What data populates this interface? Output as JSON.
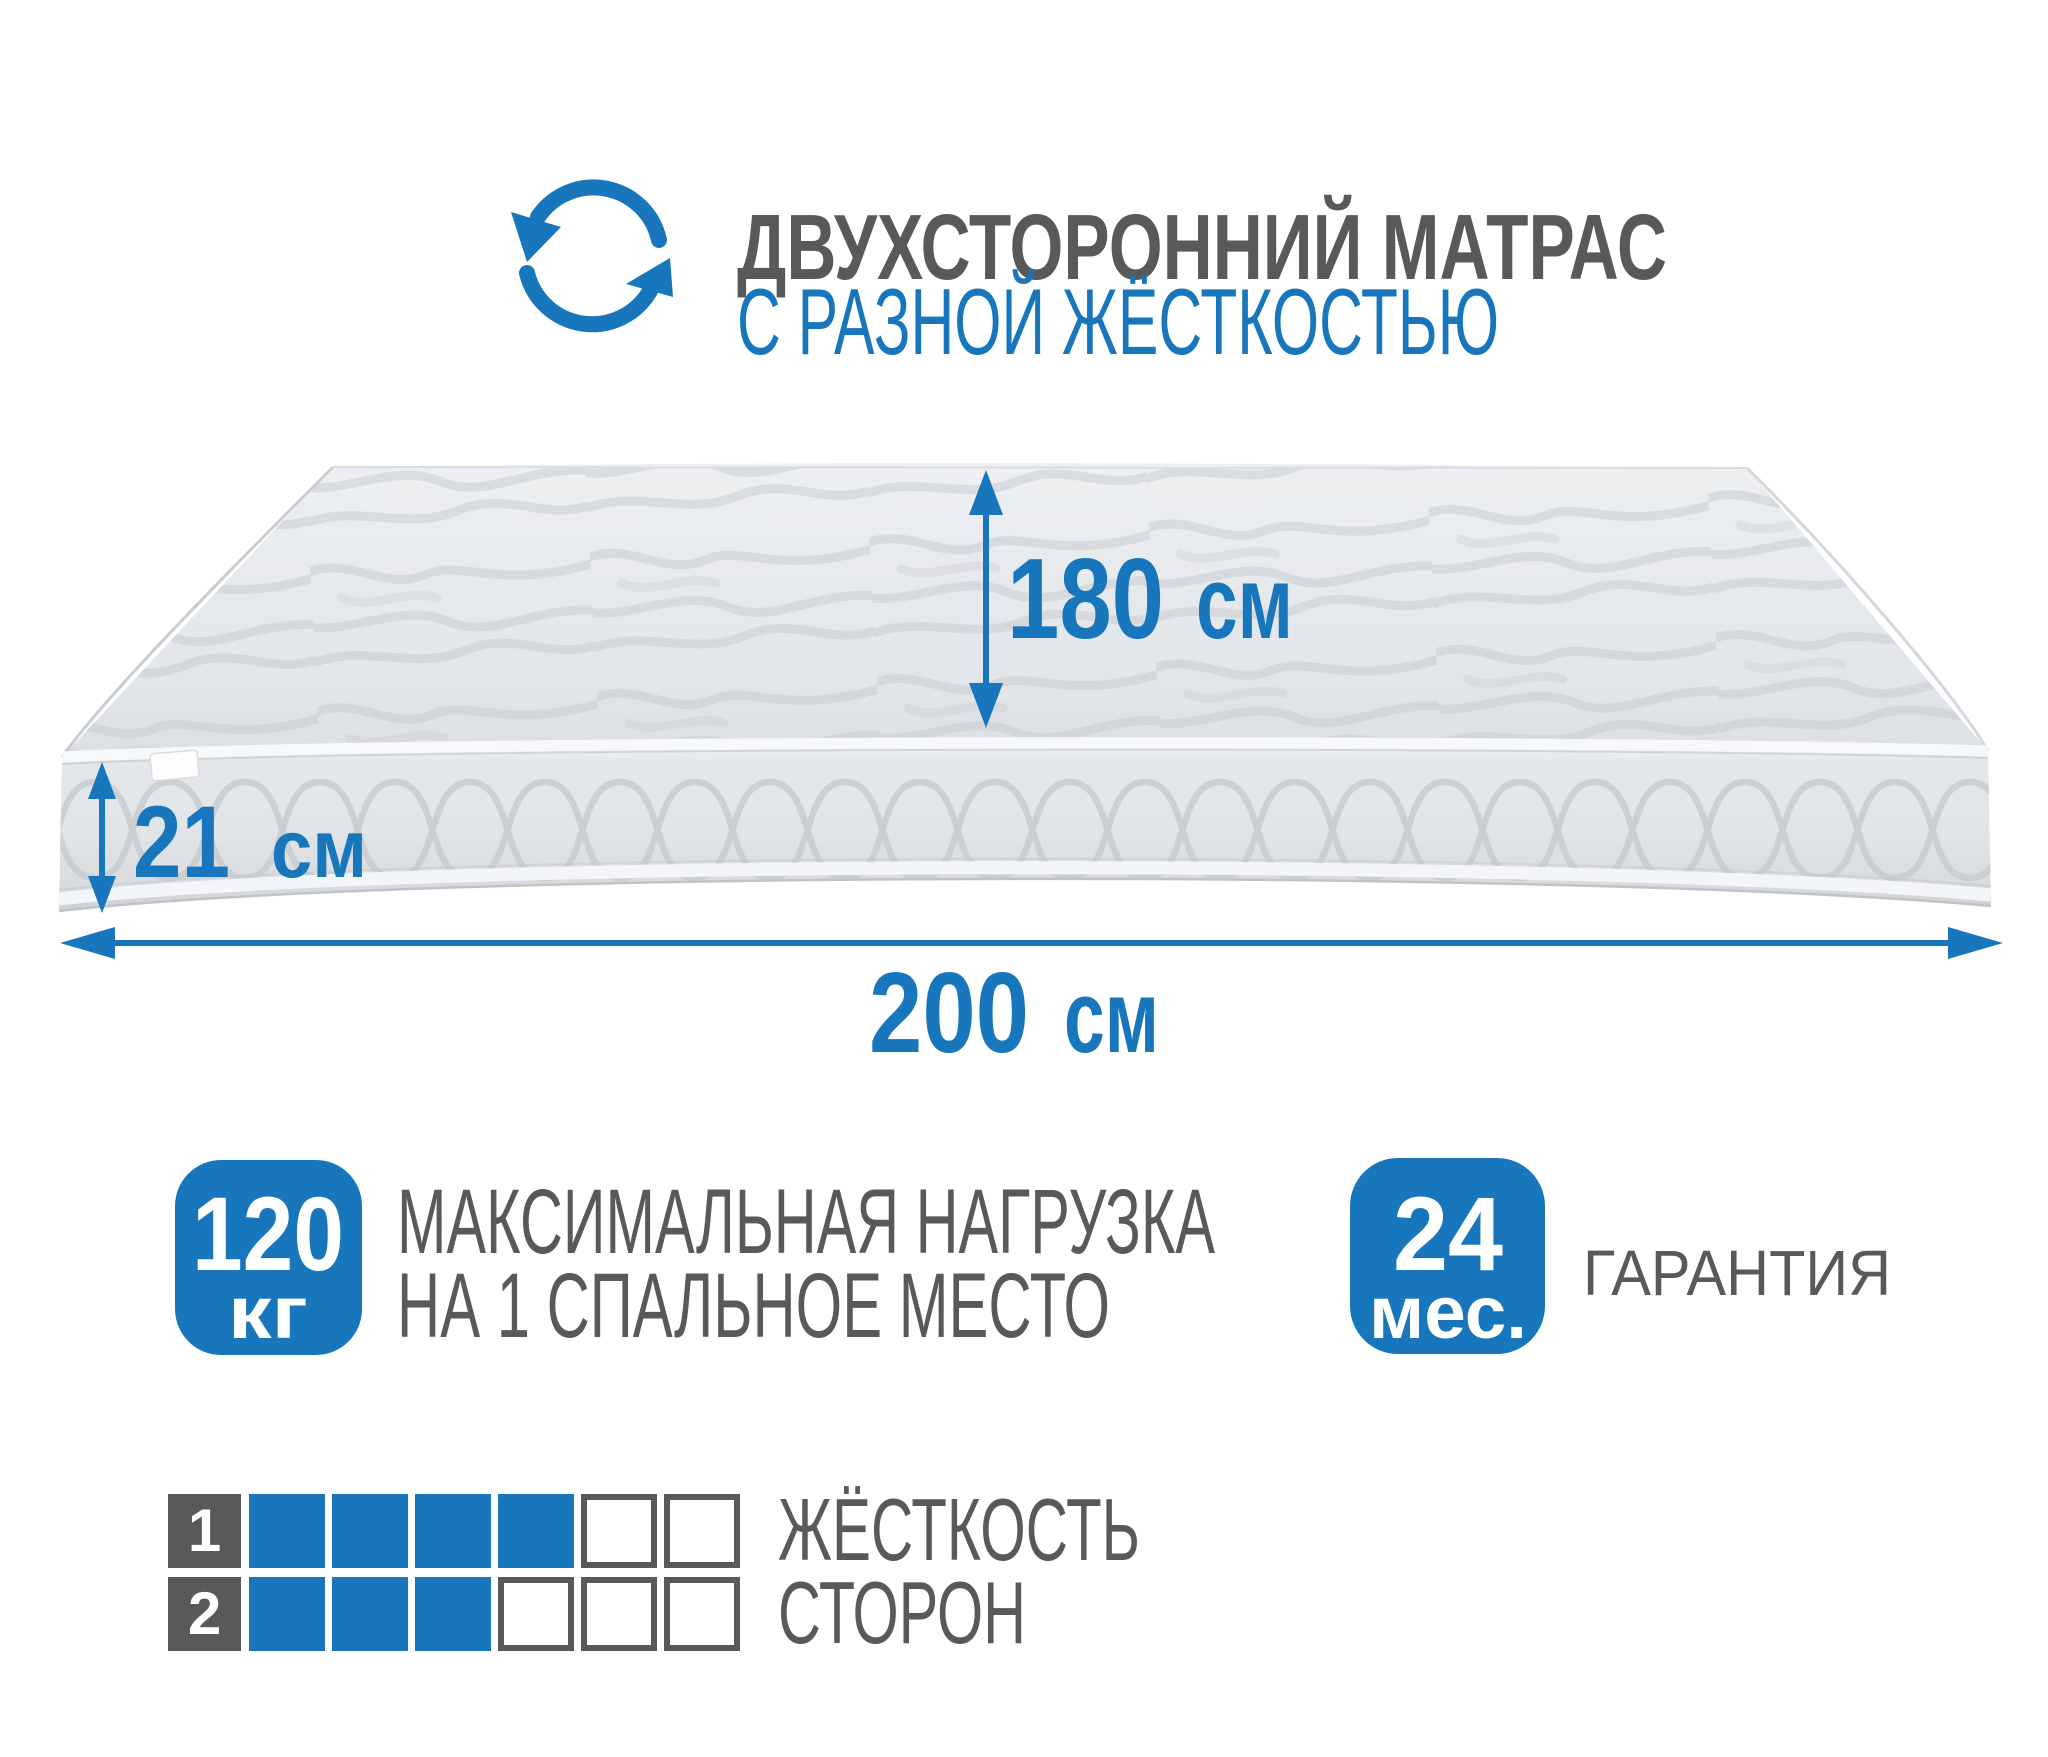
{
  "header": {
    "title": "ДВУХСТОРОННИЙ МАТРАС",
    "subtitle": "С РАЗНОЙ ЖЁСТКОСТЬЮ",
    "icon": "rotate-arrows-icon"
  },
  "dimensions": {
    "width": {
      "value": "180",
      "unit": "см"
    },
    "height": {
      "value": "21",
      "unit": "см"
    },
    "length": {
      "value": "200",
      "unit": "см"
    }
  },
  "features": {
    "max_load": {
      "badge_value": "120",
      "badge_unit": "кг",
      "label_line1": "МАКСИМАЛЬНАЯ НАГРУЗКА",
      "label_line2": "НА 1 СПАЛЬНОЕ МЕСТО"
    },
    "warranty": {
      "badge_value": "24",
      "badge_unit": "мес.",
      "label": "ГАРАНТИЯ"
    }
  },
  "firmness": {
    "label_line1": "ЖЁСТКОСТЬ",
    "label_line2": "СТОРОН",
    "total": 6,
    "rows": [
      {
        "side": "1",
        "filled": 4
      },
      {
        "side": "2",
        "filled": 3
      }
    ]
  },
  "palette": {
    "blue": "#1776bc",
    "gray": "#58595b"
  }
}
